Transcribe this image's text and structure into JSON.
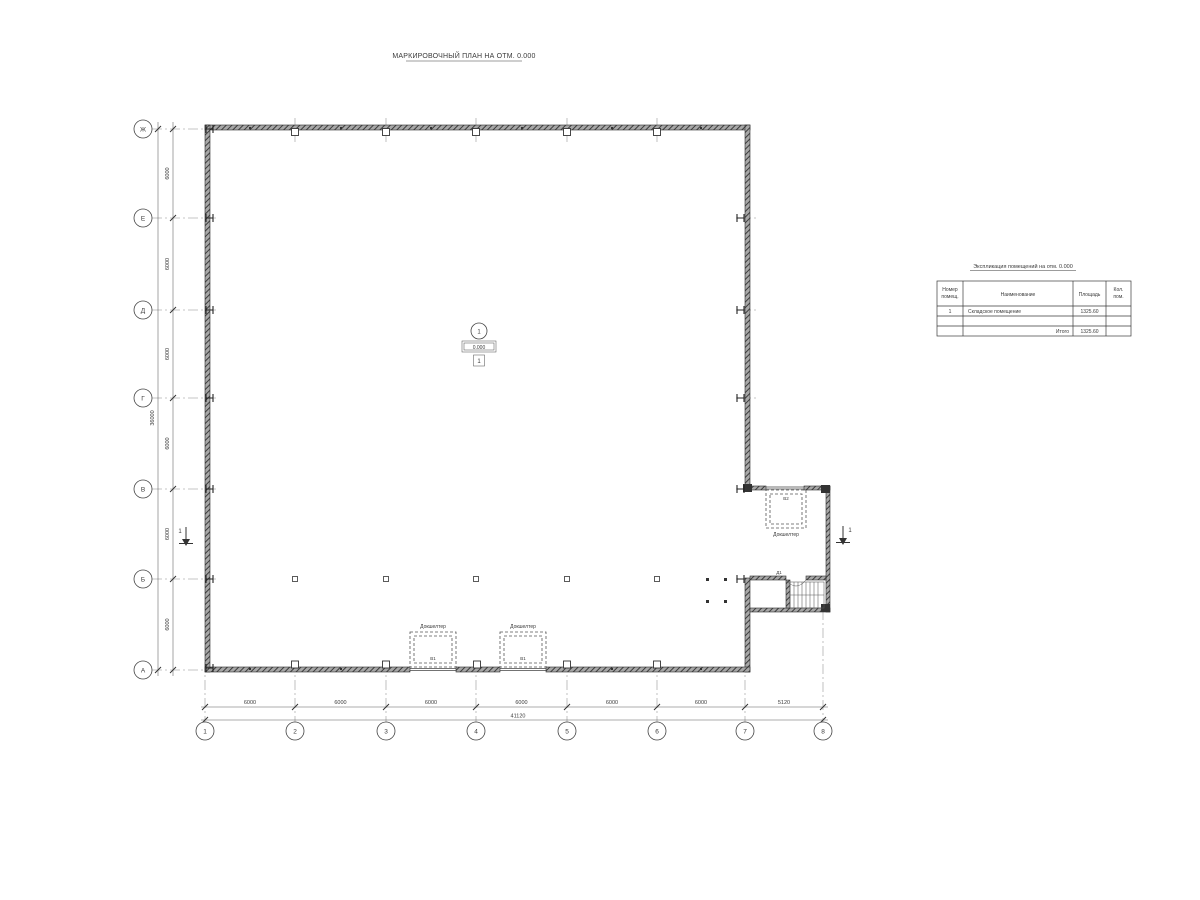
{
  "title": "МАРКИРОВОЧНЫЙ ПЛАН НА ОТМ. 0.000",
  "axes": {
    "rows": [
      "Ж",
      "Е",
      "Д",
      "Г",
      "В",
      "Б",
      "А"
    ],
    "cols": [
      "1",
      "2",
      "3",
      "4",
      "5",
      "6",
      "7",
      "8"
    ]
  },
  "dims": {
    "left_spans": [
      "6000",
      "6000",
      "6000",
      "6000",
      "6000",
      "6000"
    ],
    "left_total": "36000",
    "bottom_spans": [
      "6000",
      "6000",
      "6000",
      "6000",
      "6000",
      "6000",
      "5120"
    ],
    "bottom_total": "41120"
  },
  "marks": {
    "room_number": "1",
    "level": "0.000",
    "floor_type": "1",
    "section_left": "1",
    "section_right": "1",
    "door": "Д1",
    "dock_shelter_label": "Докшелтер",
    "gates": {
      "left_dock": "В1",
      "right_dock": "В1",
      "annex_dock": "В2"
    }
  },
  "table": {
    "title": "Экспликация помещений на отм. 0.000",
    "headers": {
      "num_line1": "Номер",
      "num_line2": "помещ.",
      "name": "Наименование",
      "area": "Площадь",
      "count_line1": "Кол.",
      "count_line2": "пом."
    },
    "rows": [
      {
        "num": "1",
        "name": "Складское помещение",
        "area": "1325.60",
        "count": ""
      }
    ],
    "total_label": "Итого",
    "total_area": "1325.60"
  }
}
